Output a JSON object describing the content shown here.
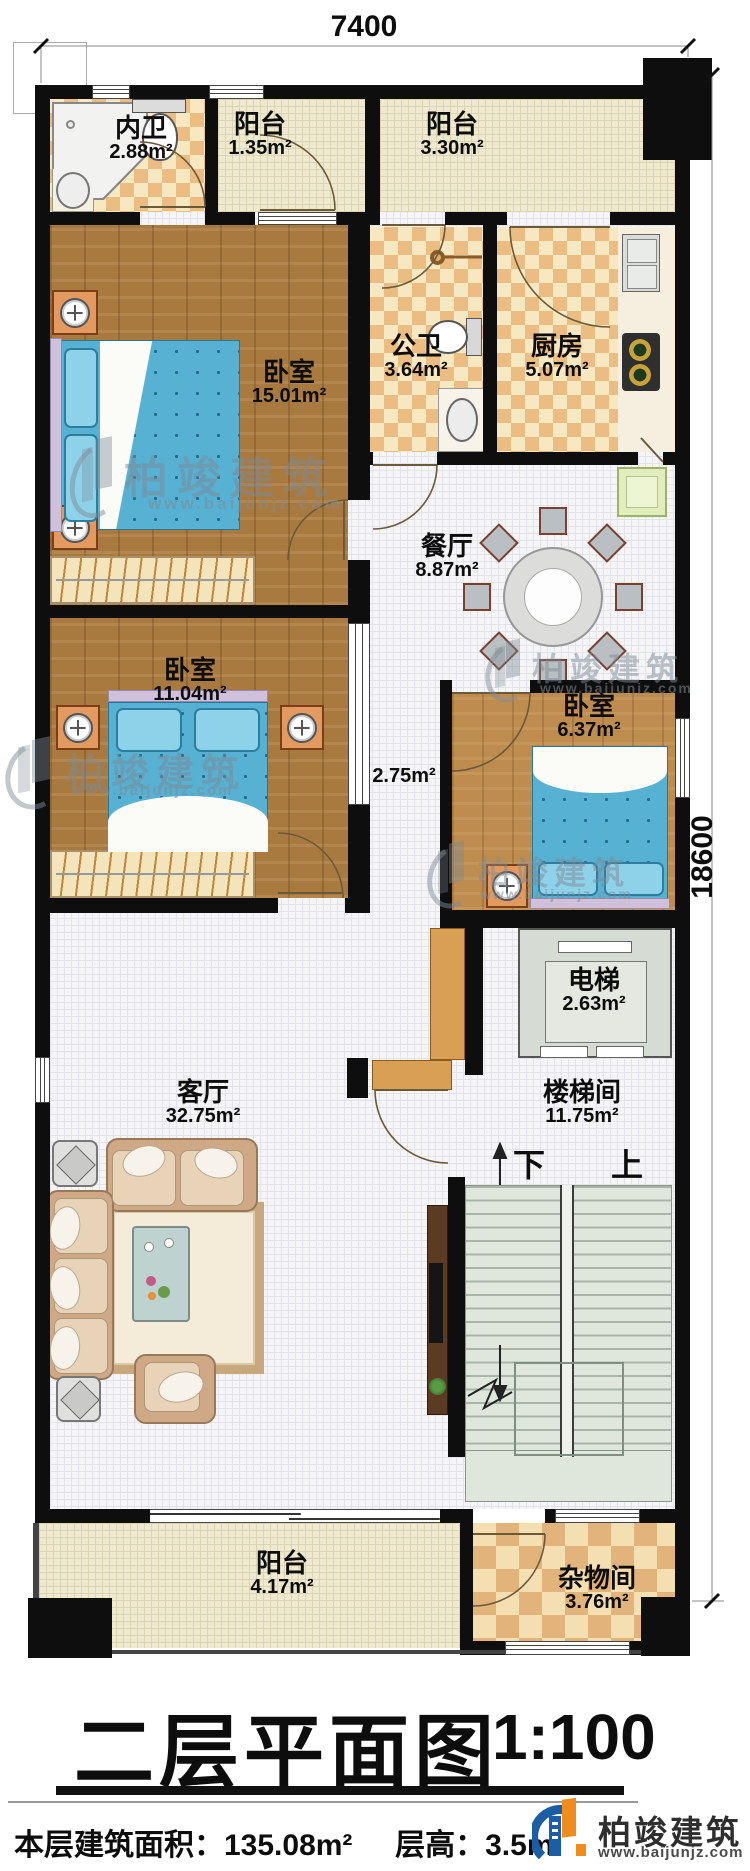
{
  "dimensions": {
    "top": "7400",
    "right": "18600"
  },
  "rooms": {
    "neiwei": {
      "name": "内卫",
      "area": "2.88m²"
    },
    "balcony_top_left": {
      "name": "阳台",
      "area": "1.35m²"
    },
    "balcony_top_right": {
      "name": "阳台",
      "area": "3.30m²"
    },
    "bedroom_master": {
      "name": "卧室",
      "area": "15.01m²"
    },
    "gongwei": {
      "name": "公卫",
      "area": "3.64m²"
    },
    "kitchen": {
      "name": "厨房",
      "area": "5.07m²"
    },
    "dining": {
      "name": "餐厅",
      "area": "8.87m²"
    },
    "bedroom_right": {
      "name": "卧室",
      "area": "6.37m²"
    },
    "bedroom_left": {
      "name": "卧室",
      "area": "11.04m²"
    },
    "hallway": {
      "area": "2.75m²"
    },
    "elevator": {
      "name": "电梯",
      "area": "2.63m²"
    },
    "living": {
      "name": "客厅",
      "area": "32.75m²"
    },
    "stairwell": {
      "name": "楼梯间",
      "area": "11.75m²"
    },
    "stair_down": "下",
    "stair_up": "上",
    "balcony_bottom": {
      "name": "阳台",
      "area": "4.17m²"
    },
    "storage": {
      "name": "杂物间",
      "area": "3.76m²"
    }
  },
  "title": {
    "text": "二层平面图",
    "scale": "1:100"
  },
  "footer": {
    "area_label": "本层建筑面积：135.08m²",
    "height_label": "层高：3.5m"
  },
  "brand": {
    "name": "柏竣建筑",
    "url": "www.baijunjz.com"
  }
}
